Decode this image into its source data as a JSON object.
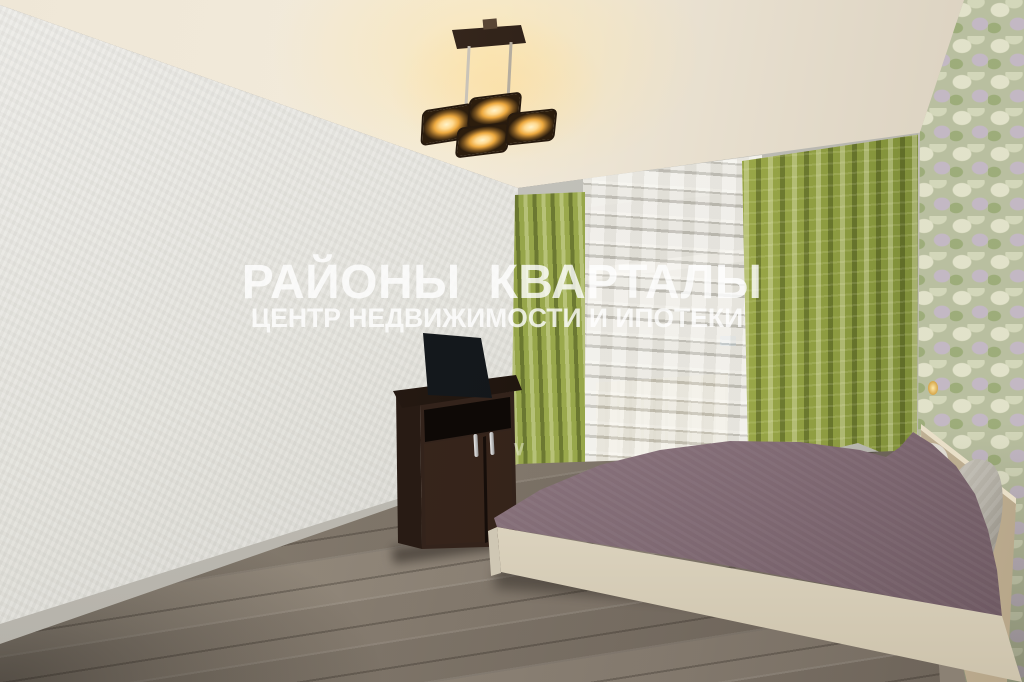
{
  "image": {
    "kind": "real-estate interior photograph",
    "room": "bedroom with window, bed and TV cabinet",
    "width_px": 1024,
    "height_px": 682
  },
  "watermark": {
    "title": "РАЙОНЫ  КВАРТАЛЫ",
    "subtitle": "ЦЕНТР НЕДВИЖИМОСТИ И ИПОТЕКИ",
    "mark": "∨",
    "color": "#ffffff",
    "opacity": 0.8
  },
  "scene": {
    "objects": [
      {
        "name": "ceiling-lamp",
        "label": "four-light square ceiling fixture, switched on"
      },
      {
        "name": "window",
        "label": "window with white striped sheer tulle"
      },
      {
        "name": "curtains",
        "label": "olive-green satin curtains, left and right panels"
      },
      {
        "name": "radiator",
        "label": "beige radiator visible through sheer below window"
      },
      {
        "name": "tv",
        "label": "flat-screen TV standing on cabinet"
      },
      {
        "name": "tv-stand",
        "label": "dark brown two-door cabinet with metal handles"
      },
      {
        "name": "bed",
        "label": "double bed with mauve coverlet and cream frame"
      },
      {
        "name": "headboard",
        "label": "light wood headboard"
      },
      {
        "name": "pillows",
        "label": "white and grey pillows"
      },
      {
        "name": "accent-wall",
        "label": "floral hydrangea wallpaper on right wall"
      },
      {
        "name": "left-wall",
        "label": "plain light-grey textured wallpaper"
      },
      {
        "name": "floor",
        "label": "grey-brown laminate plank floor"
      }
    ],
    "colors": {
      "ceiling": "#efe7d7",
      "left-wall": "#e4e3dd",
      "window-wall": "#c0bfb8",
      "baseboard": "#b5b2aa",
      "curtain-light": "#9aa94c",
      "curtain-mid": "#93a345",
      "curtain-dark": "#5c6a2a",
      "sheer": "#ece9e1",
      "radiator": "#d5c8a0",
      "floral-base": "#b9bfa0",
      "floor-light": "#9a9184",
      "floor-dark": "#675e54",
      "stand-brown": "#33231b",
      "tv-screen": "#14181c",
      "bedspread": "#97808a",
      "bed-frame": "#f0e9d8",
      "headboard": "#d5c9ae",
      "pillow-grey": "#aeaaa0",
      "lamp-amber": "#eda93f"
    }
  }
}
